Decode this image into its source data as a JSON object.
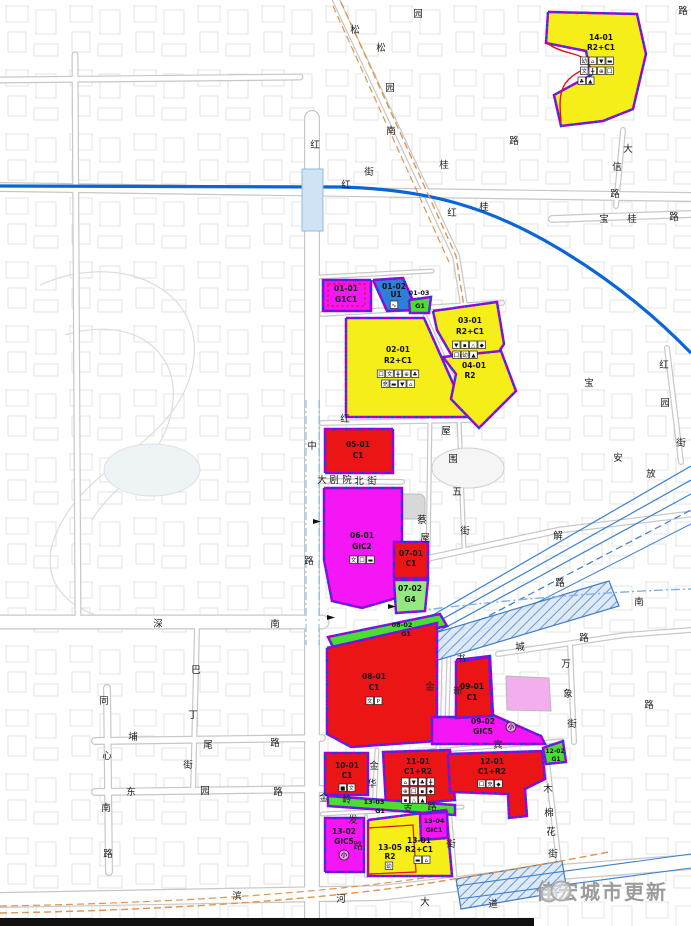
{
  "watermark": {
    "text": "佳宏城市更新"
  },
  "palette": {
    "yellow": "#f6ee18",
    "red": "#ec1515",
    "magenta": "#f416f4",
    "green": "#4ade34",
    "green_light": "#93e87e",
    "blue": "#2e7fd8",
    "pink": "#f3aeee",
    "metro": "#0a65d6",
    "rail": "#3a7fd0",
    "orange": "#e0944e",
    "boundary": "#a100d8",
    "boundary2": "#2438e8",
    "road": "#c7c7c7",
    "label": "#101010",
    "street_text": "#222222",
    "station_fill": "#cfe3f5",
    "station_edge": "#8fb8dd",
    "frame": "#111111"
  },
  "frame": {
    "bar": [
      0,
      918,
      534,
      8
    ]
  },
  "park": {
    "paths": [
      "M40,285 C130,245 225,300 185,390 C155,455 75,470 52,545 C44,580 62,602 95,615",
      "M65,335 C140,312 195,360 165,432 C150,470 110,488 92,520"
    ],
    "pond": [
      152,
      470,
      48,
      26
    ]
  },
  "buildings": [
    {
      "rrect": [
        397,
        494,
        28,
        25,
        6
      ]
    },
    {
      "ellipse": [
        468,
        468,
        36,
        20
      ]
    }
  ],
  "roads": [
    [
      "M312,118 L312,926",
      16
    ],
    [
      "M0,622 L322,622",
      15
    ],
    [
      "M0,900 L380,893 L560,872 L691,862",
      16
    ],
    [
      "M95,741 L322,738",
      8
    ],
    [
      "M95,792 L322,789",
      8
    ],
    [
      "M107,688 L109,872",
      8
    ],
    [
      "M197,628 L193,792",
      6
    ],
    [
      "M0,187 L691,197",
      10
    ],
    [
      "M336,0 L456,256 L468,330",
      8
    ],
    [
      "M552,219 L691,214",
      8
    ],
    [
      "M623,130 L616,206",
      6
    ],
    [
      "M667,348 L681,462",
      6
    ],
    [
      "M570,644 L574,742",
      6
    ],
    [
      "M498,654 L625,635 L691,630",
      6
    ],
    [
      "M420,560 L560,530 L691,514",
      7
    ],
    [
      "M322,481 L402,482",
      6
    ],
    [
      "M430,418 L428,562",
      5
    ],
    [
      "M459,418 L464,548",
      5
    ],
    [
      "M322,423 L470,420",
      6
    ],
    [
      "M322,314 L502,303",
      6
    ],
    [
      "M320,277 L432,271",
      5
    ],
    [
      "M425,316 L470,418",
      5
    ],
    [
      "M377,750 L374,808",
      5
    ],
    [
      "M430,751 L562,741",
      5
    ],
    [
      "M449,655 L447,719",
      5
    ],
    [
      "M546,753 L560,872",
      6
    ],
    [
      "M322,814 L462,807",
      5
    ],
    [
      "M366,816 L366,876",
      4
    ],
    [
      "M449,808 L455,878",
      5
    ],
    [
      "M441,622 L438,752",
      5
    ],
    [
      "M75,55 L78,620",
      7
    ],
    [
      "M0,80 L300,77",
      7
    ]
  ],
  "transit": [
    {
      "d": "M0,186 L340,187 C430,189 492,209 556,247 C612,280 656,317 691,353",
      "s": "metro",
      "w": 3.2
    },
    {
      "rect": [
        302,
        169,
        21,
        62
      ]
    },
    {
      "d": "M306,400 L306,645",
      "s": "#7fb3e8",
      "w": 1,
      "da": "8 3 2 3"
    },
    {
      "d": "M319,400 L319,645",
      "s": "#7fb3e8",
      "w": 1,
      "da": "8 3 2 3"
    },
    {
      "d": "M362,656 L691,466",
      "s": "rail",
      "w": 1.2
    },
    {
      "d": "M355,668 L691,480",
      "s": "rail",
      "w": 1.2
    },
    {
      "d": "M349,680 L691,494",
      "s": "rail",
      "w": 1.2
    },
    {
      "d": "M343,692 L691,510",
      "s": "rail",
      "w": 1.2,
      "da": "7 4"
    },
    {
      "d": "M338,704 L691,524",
      "s": "rail",
      "w": 1
    },
    {
      "poly": "408,641 609,581 619,606 418,666",
      "h": true
    },
    {
      "poly": "456,879 562,861 567,891 461,909",
      "h": true
    },
    {
      "d": "M400,613 C500,600 600,592 691,589",
      "s": "#7fb3e8",
      "w": 1.4,
      "da": "9 3 2 3"
    },
    {
      "d": "M456,886 L691,854",
      "s": "rail",
      "w": 1.1
    },
    {
      "d": "M459,899 L691,868",
      "s": "rail",
      "w": 1.1
    },
    {
      "d": "M341,2 L456,256 L468,332",
      "s": "orange",
      "w": 1.4,
      "da": "7 4"
    },
    {
      "d": "M333,6 L449,262",
      "s": "orange",
      "w": 1.2,
      "da": "7 4"
    },
    {
      "d": "M0,913 C180,910 340,898 442,881 C520,868 565,861 608,852",
      "s": "orange",
      "w": 1.4,
      "da": "7 4"
    },
    {
      "d": "M0,906 C180,903 335,892 436,876",
      "s": "orange",
      "w": 1.2,
      "da": "7 4"
    }
  ],
  "parcels": [
    {
      "id": "14-01",
      "f": "yellow",
      "pts": "548,12 637,14 646,54 633,109 603,121 561,126 554,95 591,75 586,51 546,43",
      "texts": [
        {
          "t": "14-01",
          "x": 601,
          "y": 40
        },
        {
          "t": "R2+C1",
          "x": 601,
          "y": 50
        }
      ],
      "icons": [
        {
          "x": 597,
          "y": 57,
          "g": [
            "幼",
            "⌂",
            "▼",
            "▬"
          ]
        },
        {
          "x": 597,
          "y": 67,
          "g": [
            "文",
            "╋",
            "⊕",
            "囗"
          ]
        },
        {
          "x": 586,
          "y": 77,
          "g": [
            "♣",
            "▲"
          ]
        }
      ]
    },
    {
      "id": "02-01",
      "f": "yellow",
      "pts": "346,318 424,318 468,417 346,417",
      "texts": [
        {
          "t": "02-01",
          "x": 398,
          "y": 352
        },
        {
          "t": "R2+C1",
          "x": 398,
          "y": 363
        }
      ],
      "icons": [
        {
          "x": 398,
          "y": 370,
          "g": [
            "囗",
            "文",
            "╋",
            "⊕",
            "♣"
          ]
        },
        {
          "x": 398,
          "y": 380,
          "g": [
            "充",
            "▬",
            "▼",
            "⌂"
          ]
        }
      ]
    },
    {
      "id": "03-01",
      "f": "yellow",
      "pts": "433,311 497,302 504,344 479,382 452,356 437,330",
      "texts": [
        {
          "t": "03-01",
          "x": 470,
          "y": 323
        },
        {
          "t": "R2+C1",
          "x": 470,
          "y": 334
        }
      ],
      "icons": [
        {
          "x": 469,
          "y": 341,
          "g": [
            "▼",
            "▪",
            "△",
            "◆"
          ]
        },
        {
          "x": 465,
          "y": 351,
          "g": [
            "囗",
            "幼",
            "▲"
          ]
        }
      ]
    },
    {
      "id": "04-01",
      "f": "yellow",
      "pts": "443,357 501,351 516,391 479,428 451,399 456,374",
      "texts": [
        {
          "t": "04-01",
          "x": 474,
          "y": 368
        },
        {
          "t": "R2",
          "x": 470,
          "y": 378
        }
      ]
    },
    {
      "id": "01-01",
      "f": "magenta",
      "pts": "323,280 371,280 371,311 323,311",
      "texts": [
        {
          "t": "01-01",
          "x": 346,
          "y": 291
        },
        {
          "t": "G1C1",
          "x": 346,
          "y": 302
        }
      ]
    },
    {
      "id": "01-02",
      "f": "blue",
      "pts": "373,280 403,278 417,310 387,311",
      "texts": [
        {
          "t": "01-02",
          "x": 394,
          "y": 289
        },
        {
          "t": "U1",
          "x": 396,
          "y": 297
        }
      ],
      "icons": [
        {
          "x": 394,
          "y": 301,
          "g": [
            "∿"
          ]
        }
      ]
    },
    {
      "id": "01-03",
      "f": "green",
      "pts": "409,300 431,297 429,313 410,313",
      "texts": [
        {
          "t": "01-03",
          "x": 419,
          "y": 295,
          "s": 6.5
        },
        {
          "t": "G1",
          "x": 420,
          "y": 308,
          "s": 6.5
        }
      ]
    },
    {
      "id": "05-01",
      "f": "red",
      "pts": "325,429 393,429 393,473 325,473",
      "texts": [
        {
          "t": "05-01",
          "x": 358,
          "y": 447
        },
        {
          "t": "C1",
          "x": 358,
          "y": 458
        }
      ]
    },
    {
      "id": "06-01",
      "f": "magenta",
      "pts": "324,488 402,488 402,556 396,598 362,608 332,601 324,560",
      "texts": [
        {
          "t": "06-01",
          "x": 362,
          "y": 538
        },
        {
          "t": "GIC2",
          "x": 362,
          "y": 549
        }
      ],
      "icons": [
        {
          "x": 362,
          "y": 556,
          "g": [
            "文",
            "囗",
            "▬"
          ]
        }
      ]
    },
    {
      "id": "07-01",
      "f": "red",
      "pts": "394,542 428,542 428,578 394,578",
      "texts": [
        {
          "t": "07-01",
          "x": 411,
          "y": 556
        },
        {
          "t": "C1",
          "x": 411,
          "y": 566
        }
      ]
    },
    {
      "id": "07-02",
      "f": "green_light",
      "pts": "394,580 428,580 425,611 396,613",
      "texts": [
        {
          "t": "07-02",
          "x": 410,
          "y": 591
        },
        {
          "t": "G4",
          "x": 410,
          "y": 602
        }
      ]
    },
    {
      "id": "08-02",
      "f": "green",
      "pts": "328,637 440,614 447,626 334,649",
      "texts": [
        {
          "t": "08-02",
          "x": 402,
          "y": 627,
          "s": 6.5
        },
        {
          "t": "G1",
          "x": 406,
          "y": 636,
          "s": 6.5
        }
      ]
    },
    {
      "id": "08-01",
      "f": "red",
      "pts": "327,648 437,623 437,741 351,747 327,734",
      "texts": [
        {
          "t": "08-01",
          "x": 374,
          "y": 679
        },
        {
          "t": "C1",
          "x": 374,
          "y": 690
        }
      ],
      "icons": [
        {
          "x": 374,
          "y": 697,
          "g": [
            "文",
            "P"
          ]
        }
      ]
    },
    {
      "id": "09-02",
      "f": "magenta",
      "pts": "432,744 432,717 457,717 457,660 490,656 493,715 541,736 545,744",
      "texts": [
        {
          "t": "09-02",
          "x": 483,
          "y": 724
        },
        {
          "t": "GIC5",
          "x": 483,
          "y": 734
        },
        {
          "t": "小",
          "x": 511,
          "y": 729,
          "s": 6,
          "c": true
        }
      ]
    },
    {
      "id": "09-01",
      "f": "red",
      "pts": "456,662 489,657 492,716 456,718",
      "texts": [
        {
          "t": "09-01",
          "x": 472,
          "y": 689
        },
        {
          "t": "C1",
          "x": 472,
          "y": 700
        }
      ]
    },
    {
      "id": "pink",
      "f": "pink",
      "plain": true,
      "pts": "506,676 549,678 551,711 507,710",
      "texts": []
    },
    {
      "id": "10-01",
      "f": "red",
      "pts": "325,753 368,753 368,795 325,795",
      "texts": [
        {
          "t": "10-01",
          "x": 347,
          "y": 768
        },
        {
          "t": "C1",
          "x": 347,
          "y": 778
        }
      ],
      "icons": [
        {
          "x": 347,
          "y": 784,
          "g": [
            "■",
            "文"
          ]
        }
      ]
    },
    {
      "id": "11-01",
      "f": "red",
      "pts": "383,752 450,750 455,800 386,806",
      "texts": [
        {
          "t": "11-01",
          "x": 418,
          "y": 764
        },
        {
          "t": "C1+R2",
          "x": 418,
          "y": 774
        }
      ],
      "icons": [
        {
          "x": 418,
          "y": 778,
          "g": [
            "⌂",
            "▼",
            "♣",
            "╋"
          ]
        },
        {
          "x": 418,
          "y": 787,
          "g": [
            "⊕",
            "囗",
            "▪",
            "◆"
          ]
        },
        {
          "x": 414,
          "y": 796,
          "g": [
            "▪",
            "△",
            "▲"
          ]
        }
      ]
    },
    {
      "id": "12-01",
      "f": "red",
      "pts": "448,754 542,751 545,779 525,789 527,816 509,818 508,794 450,792",
      "texts": [
        {
          "t": "12-01",
          "x": 492,
          "y": 764
        },
        {
          "t": "C1+R2",
          "x": 492,
          "y": 774
        }
      ],
      "icons": [
        {
          "x": 490,
          "y": 780,
          "g": [
            "囗",
            "充",
            "◆"
          ]
        }
      ]
    },
    {
      "id": "12-02",
      "f": "green",
      "pts": "543,748 563,741 566,762 546,764",
      "texts": [
        {
          "t": "12-02",
          "x": 555,
          "y": 753,
          "s": 6
        },
        {
          "t": "G1",
          "x": 556,
          "y": 761,
          "s": 6
        }
      ]
    },
    {
      "id": "13-03",
      "f": "green",
      "pts": "328,796 455,805 455,815 328,806",
      "texts": [
        {
          "t": "13-03",
          "x": 374,
          "y": 804,
          "s": 6.5
        },
        {
          "t": "G1",
          "x": 380,
          "y": 813,
          "s": 6.5
        }
      ]
    },
    {
      "id": "13-02",
      "f": "magenta",
      "pts": "325,818 364,818 364,872 325,872",
      "texts": [
        {
          "t": "13-02",
          "x": 344,
          "y": 834
        },
        {
          "t": "GIC5",
          "x": 344,
          "y": 844
        },
        {
          "t": "小",
          "x": 344,
          "y": 857,
          "s": 6,
          "c": true
        }
      ]
    },
    {
      "id": "13-05",
      "f": "yellow",
      "pts": "368,820 446,810 452,876 368,876",
      "texts": [
        {
          "t": "13-05",
          "x": 390,
          "y": 850
        },
        {
          "t": "R2",
          "x": 390,
          "y": 859
        },
        {
          "t": "13-01",
          "x": 419,
          "y": 843
        },
        {
          "t": "R2+C1",
          "x": 419,
          "y": 852
        }
      ],
      "icons": [
        {
          "x": 389,
          "y": 862,
          "g": [
            "幼"
          ]
        },
        {
          "x": 422,
          "y": 856,
          "g": [
            "▬",
            "⌂"
          ]
        }
      ]
    },
    {
      "id": "13-04",
      "f": "magenta",
      "pts": "420,814 447,812 448,838 421,840",
      "texts": [
        {
          "t": "13-04",
          "x": 434,
          "y": 823,
          "s": 6.5
        },
        {
          "t": "GIC1",
          "x": 434,
          "y": 832,
          "s": 6.5
        }
      ]
    }
  ],
  "extras": [
    {
      "d": "M547,43 C566,57 584,50 589,67 C561,79 558,90 561,121",
      "w": 1.4
    },
    {
      "d": "M368,828 L413,825 L416,872 L368,874 Z",
      "w": 1.2
    },
    {
      "d": "M328,284 L365,284 L365,306 L328,306 Z",
      "w": 1,
      "da": "3 2"
    }
  ],
  "streets": [
    [
      418,
      13,
      "园"
    ],
    [
      355,
      29,
      "松"
    ],
    [
      381,
      47,
      "松"
    ],
    [
      390,
      87,
      "园"
    ],
    [
      391,
      130,
      "南"
    ],
    [
      369,
      171,
      "街"
    ],
    [
      315,
      144,
      "红"
    ],
    [
      346,
      184,
      "红"
    ],
    [
      444,
      164,
      "桂"
    ],
    [
      514,
      140,
      "路"
    ],
    [
      452,
      212,
      "红"
    ],
    [
      484,
      206,
      "桂"
    ],
    [
      683,
      10,
      "路"
    ],
    [
      628,
      148,
      "大"
    ],
    [
      617,
      166,
      "信"
    ],
    [
      615,
      193,
      "路"
    ],
    [
      604,
      218,
      "宝"
    ],
    [
      632,
      218,
      "桂"
    ],
    [
      674,
      216,
      "路"
    ],
    [
      664,
      364,
      "红"
    ],
    [
      665,
      402,
      "园"
    ],
    [
      681,
      442,
      "街"
    ],
    [
      589,
      382,
      "宝"
    ],
    [
      618,
      457,
      "安"
    ],
    [
      651,
      473,
      "放"
    ],
    [
      558,
      535,
      "解"
    ],
    [
      312,
      445,
      "中"
    ],
    [
      309,
      560,
      "路"
    ],
    [
      345,
      418,
      "红"
    ],
    [
      322,
      479,
      "大"
    ],
    [
      334,
      479,
      "剧"
    ],
    [
      347,
      479,
      "院"
    ],
    [
      359,
      480,
      "北"
    ],
    [
      372,
      480,
      "街"
    ],
    [
      446,
      430,
      "屋"
    ],
    [
      453,
      458,
      "围"
    ],
    [
      457,
      491,
      "五"
    ],
    [
      465,
      530,
      "街"
    ],
    [
      422,
      519,
      "蔡"
    ],
    [
      425,
      537,
      "屋"
    ],
    [
      430,
      686,
      "金"
    ],
    [
      461,
      658,
      "书"
    ],
    [
      458,
      690,
      "新"
    ],
    [
      498,
      744,
      "宾"
    ],
    [
      520,
      646,
      "城"
    ],
    [
      584,
      637,
      "路"
    ],
    [
      560,
      582,
      "路"
    ],
    [
      639,
      601,
      "南"
    ],
    [
      649,
      704,
      "路"
    ],
    [
      566,
      663,
      "万"
    ],
    [
      568,
      693,
      "象"
    ],
    [
      572,
      723,
      "街"
    ],
    [
      158,
      623,
      "深"
    ],
    [
      275,
      623,
      "南"
    ],
    [
      196,
      669,
      "巴"
    ],
    [
      193,
      714,
      "丁"
    ],
    [
      188,
      764,
      "街"
    ],
    [
      104,
      700,
      "同"
    ],
    [
      107,
      755,
      "心"
    ],
    [
      106,
      807,
      "南"
    ],
    [
      108,
      853,
      "路"
    ],
    [
      133,
      736,
      "埔"
    ],
    [
      208,
      744,
      "尾"
    ],
    [
      275,
      742,
      "路"
    ],
    [
      131,
      791,
      "东"
    ],
    [
      205,
      790,
      "园"
    ],
    [
      278,
      791,
      "路"
    ],
    [
      237,
      895,
      "滨"
    ],
    [
      341,
      898,
      "河"
    ],
    [
      425,
      901,
      "大"
    ],
    [
      493,
      903,
      "道"
    ],
    [
      374,
      765,
      "金"
    ],
    [
      372,
      783,
      "华"
    ],
    [
      324,
      797,
      "金"
    ],
    [
      347,
      799,
      "岭"
    ],
    [
      353,
      819,
      "发"
    ],
    [
      358,
      845,
      "路"
    ],
    [
      408,
      808,
      "支"
    ],
    [
      432,
      806,
      "路"
    ],
    [
      451,
      843,
      "街"
    ],
    [
      548,
      788,
      "木"
    ],
    [
      549,
      812,
      "棉"
    ],
    [
      551,
      831,
      "花"
    ],
    [
      553,
      853,
      "街"
    ]
  ],
  "markers": [
    [
      313,
      528
    ],
    [
      327,
      624
    ],
    [
      388,
      613
    ]
  ]
}
